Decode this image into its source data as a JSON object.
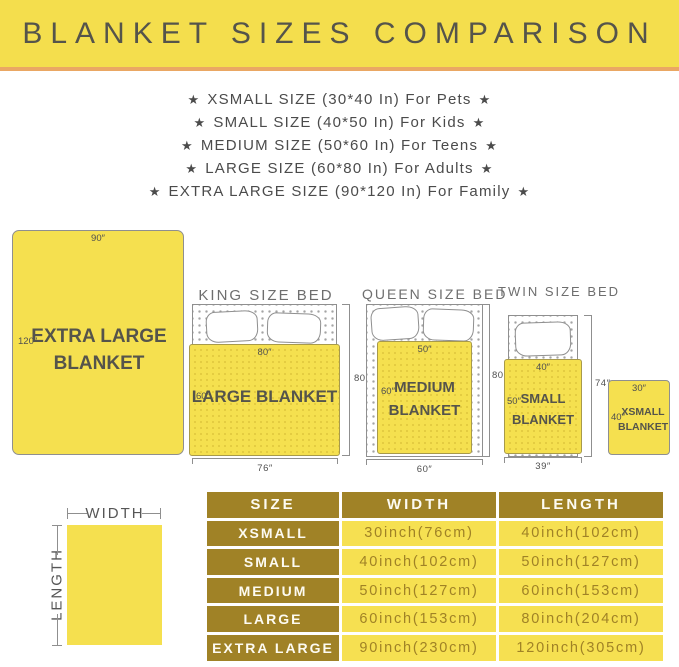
{
  "icons": {
    "star": "★"
  },
  "banner": {
    "title": "BLANKET SIZES COMPARISON"
  },
  "size_list": [
    "XSMALL SIZE (30*40 In) For Pets",
    "SMALL SIZE (40*50 In) For Kids",
    "MEDIUM SIZE (50*60 In) For Teens",
    "LARGE SIZE (60*80 In) For Adults",
    "EXTRA LARGE SIZE (90*120 In) For Family"
  ],
  "diagram": {
    "extra_large": {
      "name": "EXTRA LARGE BLANKET",
      "top_dim": "90″",
      "side_dim": "120″"
    },
    "king": {
      "title": "KING SIZE BED",
      "blanket": "LARGE BLANKET",
      "blanket_top_dim": "80″",
      "blanket_side_dim": "60″",
      "bed_width_dim": "76″",
      "bed_height_dim": "80″"
    },
    "queen": {
      "title": "QUEEN SIZE BED",
      "blanket": "MEDIUM BLANKET",
      "blanket_top_dim": "50″",
      "blanket_side_dim": "60″",
      "bed_width_dim": "60″",
      "bed_height_dim": "80″"
    },
    "twin": {
      "title": "TWIN SIZE BED",
      "blanket": "SMALL BLANKET",
      "blanket_top_dim": "40″",
      "blanket_side_dim": "50″",
      "bed_width_dim": "39″",
      "bed_height_dim": "74″"
    },
    "xsmall": {
      "name": "XSMALL BLANKET",
      "top_dim": "30″",
      "side_dim": "40″"
    },
    "legend": {
      "width_label": "WIDTH",
      "length_label": "LENGTH"
    }
  },
  "table": {
    "headers": [
      "SIZE",
      "WIDTH",
      "LENGTH"
    ],
    "rows": [
      {
        "size": "XSMALL",
        "width": "30inch(76cm)",
        "length": "40inch(102cm)"
      },
      {
        "size": "SMALL",
        "width": "40inch(102cm)",
        "length": "50inch(127cm)"
      },
      {
        "size": "MEDIUM",
        "width": "50inch(127cm)",
        "length": "60inch(153cm)"
      },
      {
        "size": "LARGE",
        "width": "60inch(153cm)",
        "length": "80inch(204cm)"
      },
      {
        "size": "EXTRA LARGE",
        "width": "90inch(230cm)",
        "length": "120inch(305cm)"
      }
    ]
  },
  "colors": {
    "banner_yellow": "#F4DE4D",
    "accent_orange": "#EAA763",
    "blanket_yellow": "#F5E04F",
    "table_gold": "#A08226",
    "cell_yellow": "#F6E051",
    "title_text": "#55544B"
  }
}
